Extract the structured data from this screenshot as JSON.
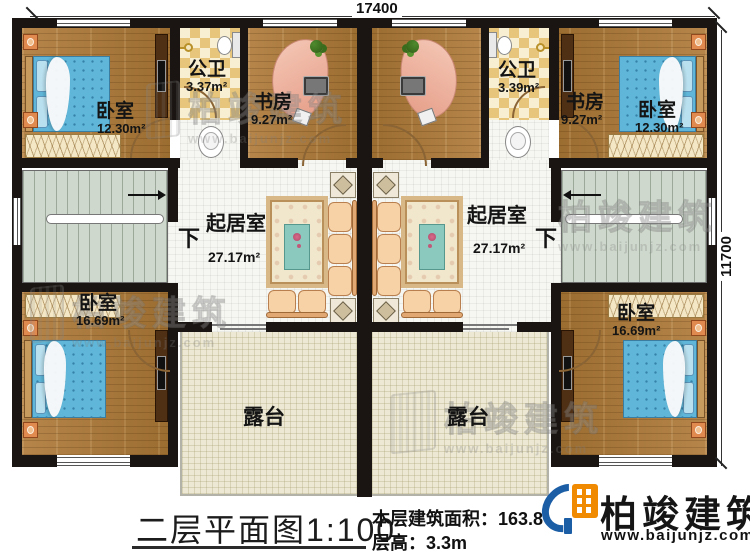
{
  "plan": {
    "dimensions": {
      "width_mm": "17400",
      "height_mm": "11700"
    },
    "rooms": {
      "bedroom_top_left": {
        "label": "卧室",
        "area": "12.30m²"
      },
      "bath_left": {
        "label": "公卫",
        "area": "3.37m²"
      },
      "study_left": {
        "label": "书房",
        "area": "9.27m²"
      },
      "study_right": {
        "label": "书房",
        "area": "9.27m²"
      },
      "bath_right": {
        "label": "公卫",
        "area": "3.39m²"
      },
      "bedroom_top_right": {
        "label": "卧室",
        "area": "12.30m²"
      },
      "living_left": {
        "label": "起居室",
        "area": "27.17m²"
      },
      "living_right": {
        "label": "起居室",
        "area": "27.17m²"
      },
      "bedroom_bottom_left": {
        "label": "卧室",
        "area": "16.69m²"
      },
      "bedroom_bottom_right": {
        "label": "卧室",
        "area": "16.69m²"
      },
      "terrace_left": {
        "label": "露台"
      },
      "terrace_right": {
        "label": "露台"
      },
      "stairs_down_left": {
        "label": "下"
      },
      "stairs_down_right": {
        "label": "下"
      }
    }
  },
  "footer": {
    "title": "二层平面图",
    "scale": "1:100",
    "floor_area": "本层建筑面积：163.8",
    "floor_height": "层高：3.3m"
  },
  "branding": {
    "logo_name": "柏竣建筑",
    "logo_url": "www.baijunjz.com",
    "watermark_text": "柏竣建筑",
    "watermark_url": "www.baijunjz.com"
  }
}
